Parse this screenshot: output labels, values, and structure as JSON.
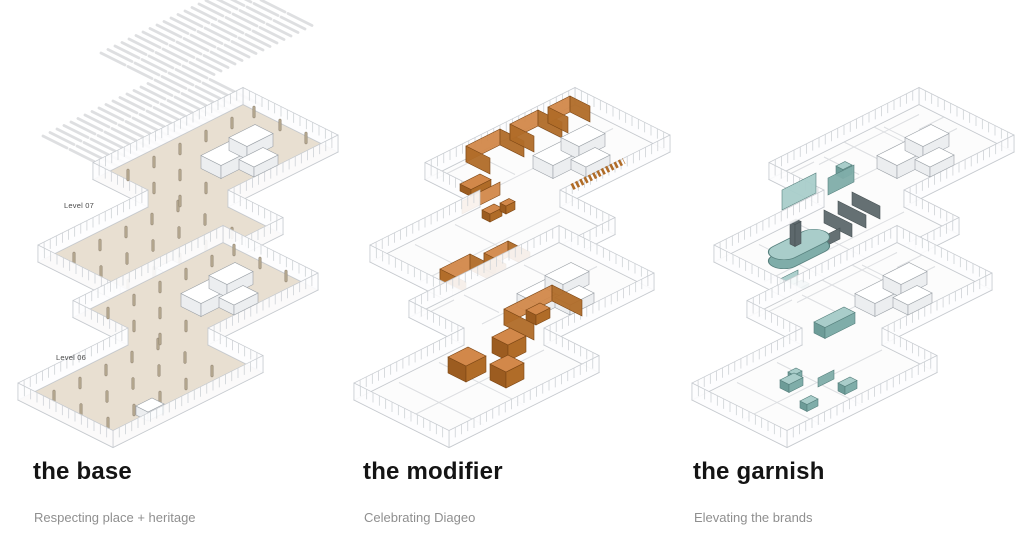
{
  "page": {
    "background": "#ffffff"
  },
  "columns": [
    {
      "key": "base",
      "title": "the base",
      "subtitle": "Respecting place + heritage",
      "scheme": "base",
      "level_labels": {
        "upper": "Level 07",
        "lower": "Level 06"
      }
    },
    {
      "key": "modifier",
      "title": "the modifier",
      "subtitle": "Celebrating Diageo",
      "scheme": "modifier",
      "level_labels": {}
    },
    {
      "key": "garnish",
      "title": "the garnish",
      "subtitle": "Elevating the brands",
      "scheme": "garnish",
      "level_labels": {}
    }
  ],
  "colors": {
    "title": "#141414",
    "subtitle": "#8f8f8f",
    "level_label": "#4a4a4a",
    "line": "#b7bbc0",
    "wall_fill": "#fdfdfe",
    "wall_line": "#c6cacf",
    "mullion": "#ced2d6",
    "base_floor": "#e8dfd1",
    "white_floor": "#fcfcfc",
    "column_fill": "#b4a78f",
    "column_line": "#8d8170",
    "hatch": "#dadcde",
    "partition": "#dcdee1",
    "core_top": "#ffffff",
    "core_side": "#eceef0",
    "core_line": "#9ba1a7",
    "orange_top": "#d2884a",
    "orange_side": "#b06c28",
    "orange_dark": "#9c5c20",
    "orange_line": "#7c4614",
    "teal_top": "#a9cdca",
    "teal_side": "#7fada9",
    "teal_dark": "#6d9c98",
    "teal_line": "#557f7c",
    "slat_dark": "#5d686c",
    "slat_dark_line": "#495356"
  }
}
